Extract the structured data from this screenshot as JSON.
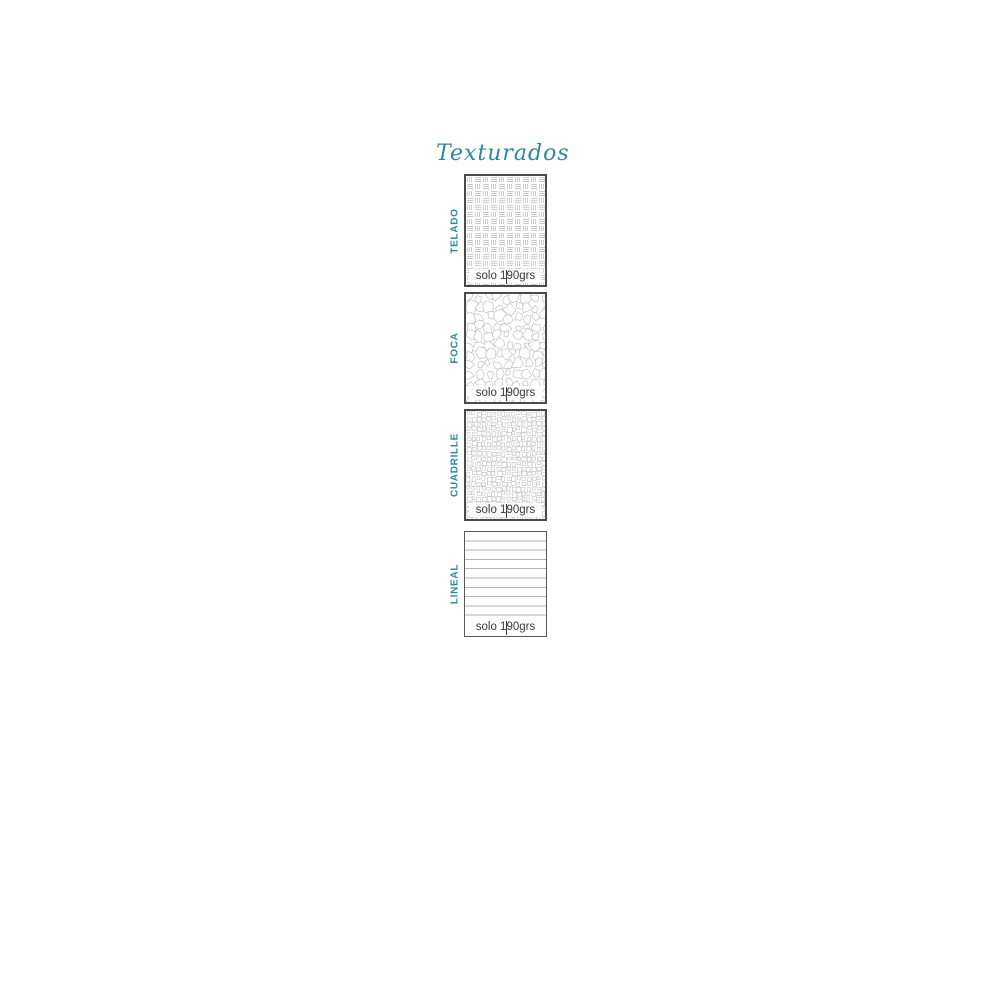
{
  "title": "Texturados",
  "colors": {
    "accent": "#2E8A9A",
    "border": "#4A4A4A",
    "text": "#3A3A3A",
    "texture_gray": "#C6C6C6"
  },
  "swatches": [
    {
      "name": "TELADO",
      "texture": "woven-dash-grid",
      "weight": "solo 190grs"
    },
    {
      "name": "FOCA",
      "texture": "crackle-pebble",
      "weight": "solo 190grs"
    },
    {
      "name": "CUADRILLE",
      "texture": "irregular-squares",
      "weight": "solo 190grs"
    },
    {
      "name": "LINEAL",
      "texture": "horizontal-rules",
      "weight": "solo 190grs"
    }
  ]
}
